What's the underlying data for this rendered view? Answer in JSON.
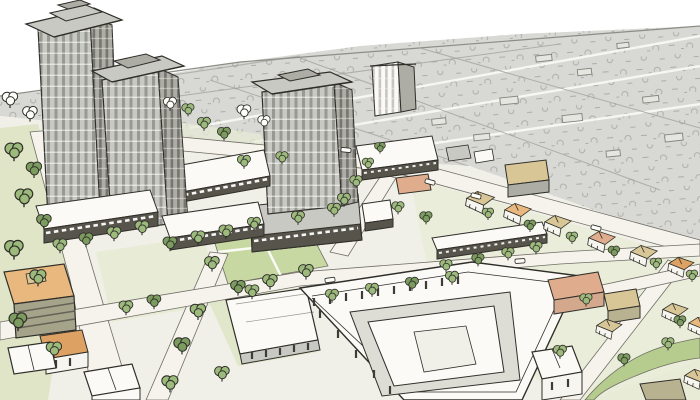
{
  "scene": {
    "title": "Aerial concept sketch of a mixed-use urban development",
    "description": "Hand-drawn pen-and-ink aerial rendering with watercolor washes: two high-rise towers and a mid-rise tower over retail podiums with white awnings, liner and townhouse blocks, a central pocket park, a large courtyard building, an orange mid-rise, tree-lined streets and a single-family neighborhood fading into a gray sketched distance under a white sky.",
    "style": "pen-and-ink sketch with watercolor wash",
    "landmarks": [
      "tall residential tower",
      "second tower",
      "center tower with cornice",
      "small slab building",
      "retail podium rows with awnings",
      "pocket park with crossing paths",
      "large courtyard building",
      "orange mixed-use building",
      "townhouse row",
      "single-family houses with hipped roofs",
      "street trees",
      "diagonal greenway",
      "distant neighborhood in gray wash"
    ]
  },
  "palette": {
    "ink": "#2f2e29",
    "paper": "#ffffff",
    "wash": "#d8d8d4",
    "wash_line": "#8d8d87",
    "ground": "#f1f0e8",
    "street": "#f5f3ec",
    "street_edge": "#6f6d64",
    "lawn": "#dfe5c6",
    "lawn_soft": "#e8ecd6",
    "park": "#c8d8a2",
    "parkway": "#b5cc8e",
    "tree": "#9dba7d",
    "tree_dark": "#7b9b5f",
    "tree_outline": "#fdfdfa",
    "facade_light": "#c9c9c3",
    "facade_mid": "#adada6",
    "facade_dark": "#8f8f88",
    "storefront": "#56544b",
    "roof_white": "#fbfaf6",
    "house_wall": "#f7f5ef",
    "roof_orange": "#e8b87e",
    "roof_orange_deep": "#dda263",
    "roof_pink": "#dfad8e",
    "roof_tan": "#d9c697",
    "roof_olive": "#b8b290",
    "wall_olive": "#a5a38a",
    "wall_pink": "#d3a88c",
    "courtyard_floor": "#dddcd5",
    "window_dark": "#3d3c36"
  }
}
